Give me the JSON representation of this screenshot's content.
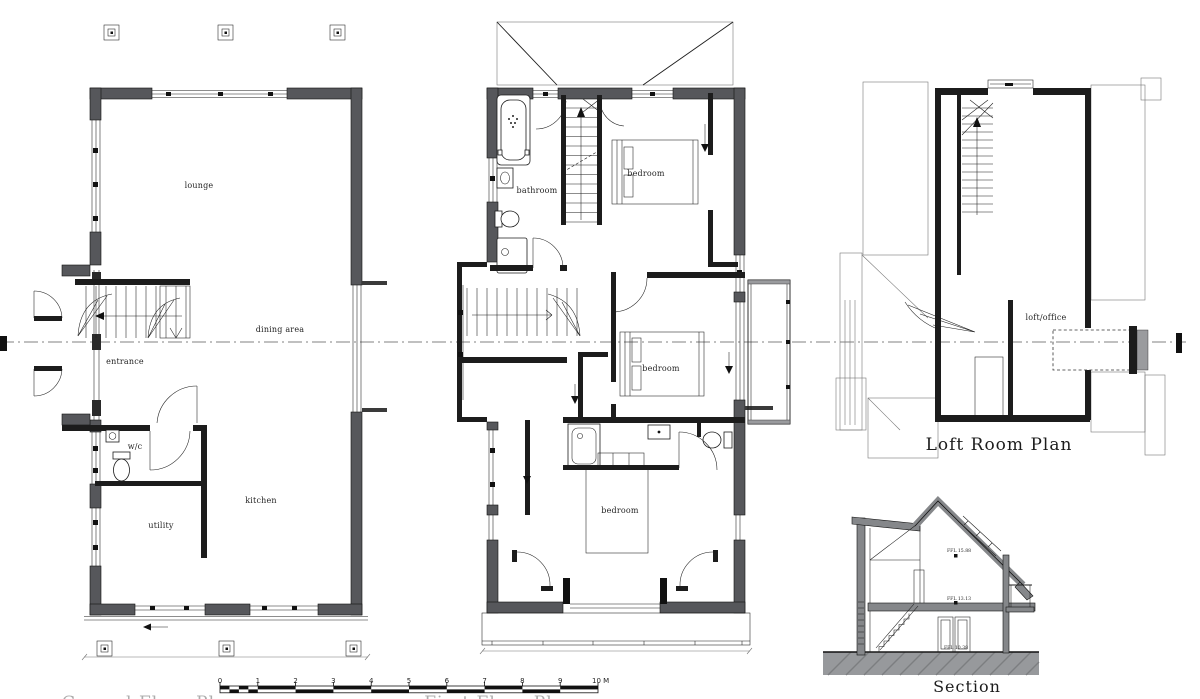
{
  "colors": {
    "wall_poche": "#56575b",
    "wall_light": "#9a9b9e",
    "line": "#1c1c1c",
    "section_poche": "#85878a",
    "ground_hatch": "#909294",
    "background": "#ffffff"
  },
  "plans": {
    "ground_floor": {
      "clipped_title": "Ground Floor Plan",
      "rooms": [
        {
          "label": "lounge"
        },
        {
          "label": "dining area"
        },
        {
          "label": "entrance"
        },
        {
          "label": "w/c"
        },
        {
          "label": "utility"
        },
        {
          "label": "kitchen"
        }
      ]
    },
    "first_floor": {
      "clipped_title": "First Floor Plan",
      "rooms": [
        {
          "label": "bathroom"
        },
        {
          "label": "bedroom"
        },
        {
          "label": "bedroom"
        },
        {
          "label": "bedroom"
        }
      ]
    },
    "loft": {
      "title": "Loft Room Plan",
      "rooms": [
        {
          "label": "loft/office"
        }
      ]
    }
  },
  "section": {
    "title": "Section",
    "levels": [
      {
        "label": "FFL 15.88"
      },
      {
        "label": "FFL 13.13"
      },
      {
        "label": "FFL 10.38"
      }
    ]
  },
  "scale_bar": {
    "ticks": [
      "0",
      "1",
      "2",
      "3",
      "4",
      "5",
      "6",
      "7",
      "8",
      "9"
    ],
    "end_label": "10 M"
  },
  "icons": {
    "fixtures": [
      "bathtub",
      "washbasin",
      "toilet",
      "shower-tray",
      "bed",
      "staircase",
      "column-marker",
      "door-swing",
      "balcony",
      "deck"
    ]
  }
}
